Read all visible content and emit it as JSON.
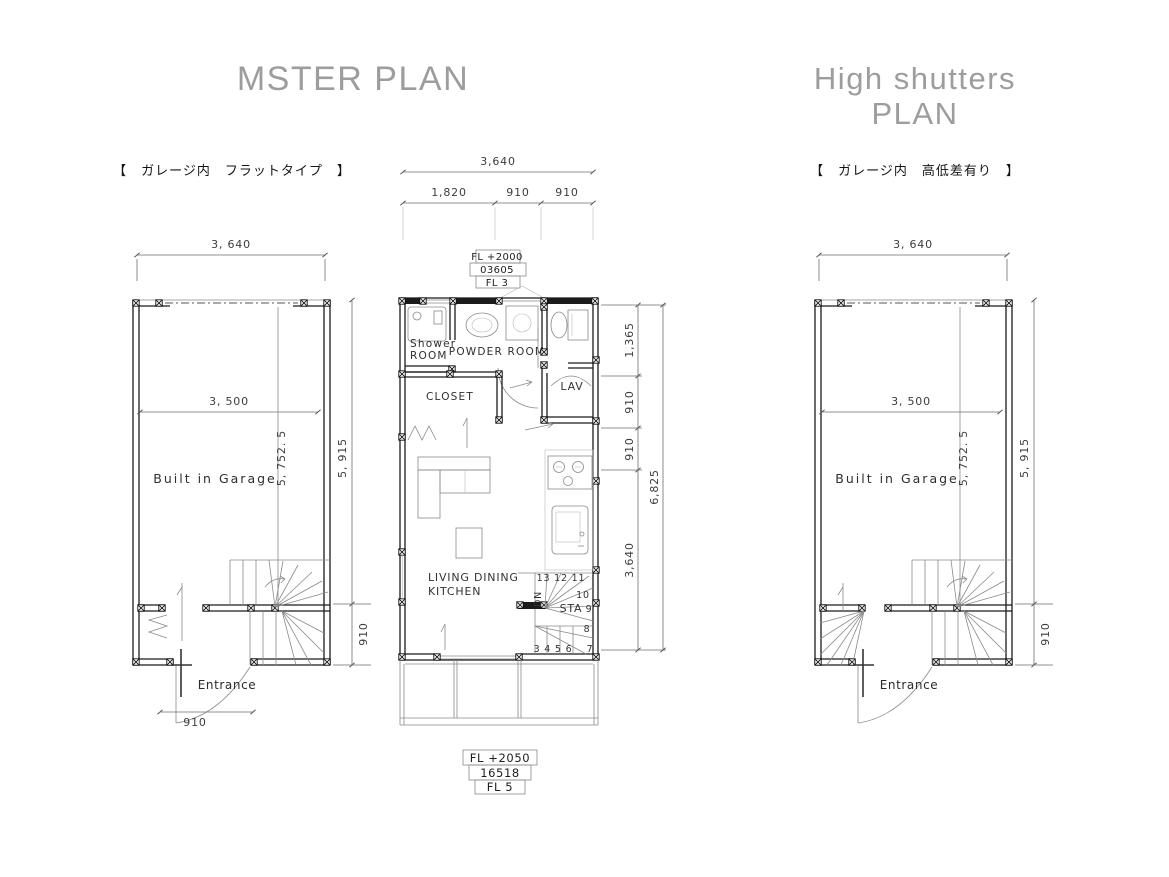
{
  "titles": {
    "master": "MSTER PLAN",
    "high_line1": "High shutters",
    "high_line2": "PLAN",
    "master_sub": "【　ガレージ内　フラットタイプ　】",
    "high_sub": "【　ガレージ内　高低差有り　】"
  },
  "master_plan": {
    "dim_overall_width": "3, 640",
    "dim_inner_width": "3, 500",
    "dim_inner_height": "5, 752. 5",
    "dim_overall_height": "5, 915",
    "dim_stair_zone": "910",
    "dim_entrance": "910",
    "garage_label": "Built in Garage",
    "entrance_label": "Entrance"
  },
  "center_plan": {
    "dim_top_overall": "3,640",
    "dim_top_seg1": "1,820",
    "dim_top_seg2": "910",
    "dim_top_seg3": "910",
    "tag_top_line1": "FL +2000",
    "tag_top_line2": "03605",
    "tag_top_line3": "FL 3",
    "tag_bottom_line1": "FL +2050",
    "tag_bottom_line2": "16518",
    "tag_bottom_line3": "FL 5",
    "room_shower_line1": "Shower",
    "room_shower_line2": "ROOM",
    "room_powder": "POWDER ROOM",
    "room_closet": "CLOSET",
    "room_lav": "LAV",
    "room_ldk_line1": "LIVING DINING",
    "room_ldk_line2": "KITCHEN",
    "stair_sta": "STA",
    "stair_dn": "DN",
    "stair_top_nums": "13 12 11",
    "stair_n10": "10",
    "stair_n9": "9",
    "stair_n8": "8",
    "stair_n7": "7",
    "stair_bottom_nums": "3 4 5 6",
    "dim_right_seg1": "1,365",
    "dim_right_seg2": "910",
    "dim_right_seg3": "910",
    "dim_right_seg4": "3,640",
    "dim_right_overall": "6,825"
  },
  "high_plan": {
    "dim_overall_width": "3, 640",
    "dim_inner_width": "3, 500",
    "dim_inner_height": "5, 752. 5",
    "dim_overall_height": "5, 915",
    "dim_stair_zone": "910",
    "garage_label": "Built in Garage",
    "entrance_label": "Entrance"
  },
  "colors": {
    "wall": "#1b1b1b",
    "dim": "#6e6e6e",
    "title": "#9d9d9d"
  }
}
